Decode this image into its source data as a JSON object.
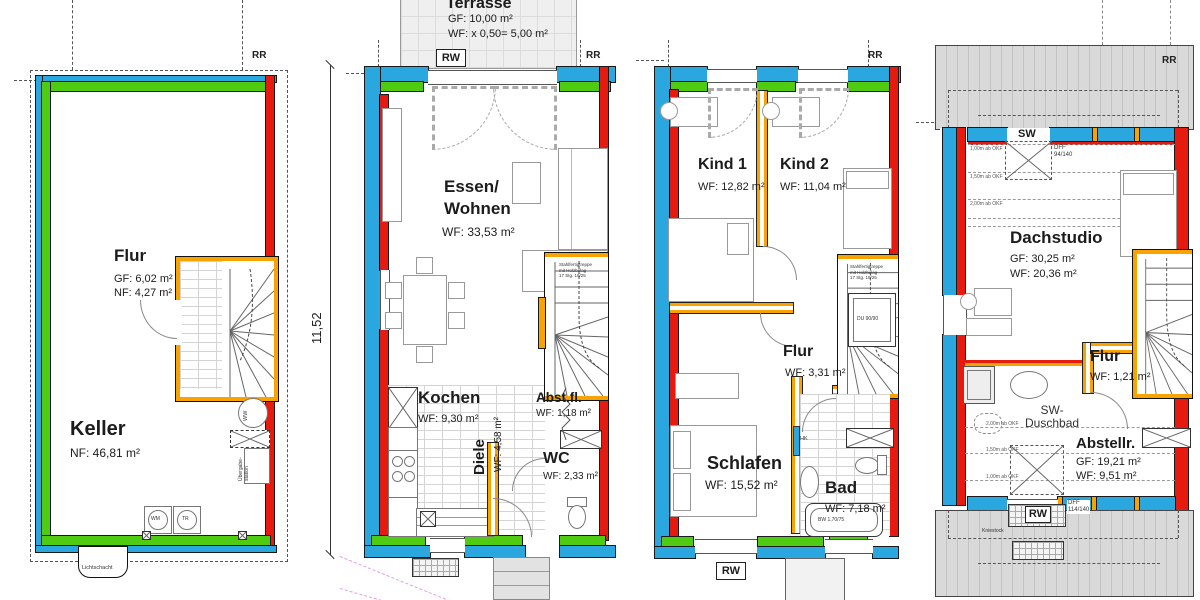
{
  "colors": {
    "wall_blue": "#2BA7E0",
    "wall_green": "#4FCC12",
    "wall_red": "#E61A0F",
    "wall_orange": "#F8A300",
    "roof_gray": "#D9D9D9",
    "boundary_pink": "#E79AE7"
  },
  "plans": {
    "keller": {
      "rr": "RR",
      "rooms": {
        "flur": {
          "name": "Flur",
          "a1": "GF: 6,02 m²",
          "a2": "NF: 4,27 m²"
        },
        "keller": {
          "name": "Keller",
          "a1": "NF: 46,81 m²"
        }
      },
      "appliances": {
        "wm": "WM",
        "tr": "TR",
        "ww": "WW"
      },
      "ueb1": "Übergabe-",
      "ueb2": "station",
      "lichtschacht": "Lichtschacht"
    },
    "eg": {
      "rr": "RR",
      "rw": "RW",
      "dim": "11,52",
      "terrasse": {
        "name": "Terrasse",
        "a1": "GF: 10,00 m²",
        "a2": "WF: x 0,50= 5,00 m²"
      },
      "rooms": {
        "essen": {
          "n1": "Essen/",
          "n2": "Wohnen",
          "a1": "WF: 33,53 m²"
        },
        "kochen": {
          "name": "Kochen",
          "a1": "WF: 9,30 m²"
        },
        "diele": {
          "name": "Diele",
          "a1": "WF: 4,58 m²"
        },
        "abstfl": {
          "name": "Abst.fl.",
          "a1": "WF: 1,18 m²"
        },
        "wc": {
          "name": "WC",
          "a1": "WF: 2,33 m²"
        }
      },
      "stair_note1": "Stahlfertigtreppe",
      "stair_note2": "mit Holzbelag",
      "stair_note3": "17 Stg. 19/25"
    },
    "og": {
      "rr": "RR",
      "rw": "RW",
      "rooms": {
        "kind1": {
          "name": "Kind 1",
          "a1": "WF: 12,82 m²"
        },
        "kind2": {
          "name": "Kind 2",
          "a1": "WF: 11,04 m²"
        },
        "flur": {
          "name": "Flur",
          "a1": "WF: 3,31 m²"
        },
        "schlafen": {
          "name": "Schlafen",
          "a1": "WF: 15,52 m²"
        },
        "bad": {
          "name": "Bad",
          "a1": "WF: 7,18 m²"
        }
      },
      "fixtures": {
        "du": "DU 90/90",
        "bw": "BW 1,70/75",
        "hk": "HK"
      },
      "stair_note1": "Stahlfertigtreppe",
      "stair_note2": "mit Holzbelag",
      "stair_note3": "17 Stg. 19/25"
    },
    "dg": {
      "rr": "RR",
      "rw": "RW",
      "sw": "SW",
      "rooms": {
        "dachstudio": {
          "name": "Dachstudio",
          "a1": "GF: 30,25 m²",
          "a2": "WF: 20,36 m²"
        },
        "flur": {
          "name": "Flur",
          "a1": "WF: 1,21 m²"
        },
        "duschbad": {
          "n1": "SW-",
          "n2": "Duschbad"
        },
        "abstellr": {
          "name": "Abstellr.",
          "a1": "GF: 19,21 m²",
          "a2": "WF: 9,51 m²"
        }
      },
      "dff_top1": "DFF",
      "dff_top2": "94/140",
      "dff_bot1": "DFF",
      "dff_bot2": "114/140",
      "heights": {
        "h100": "1,00m ab OKF",
        "h150": "1,50m ab OKF",
        "h200": "2,00m ab OKF"
      },
      "kniestock": "Kniestock"
    }
  }
}
